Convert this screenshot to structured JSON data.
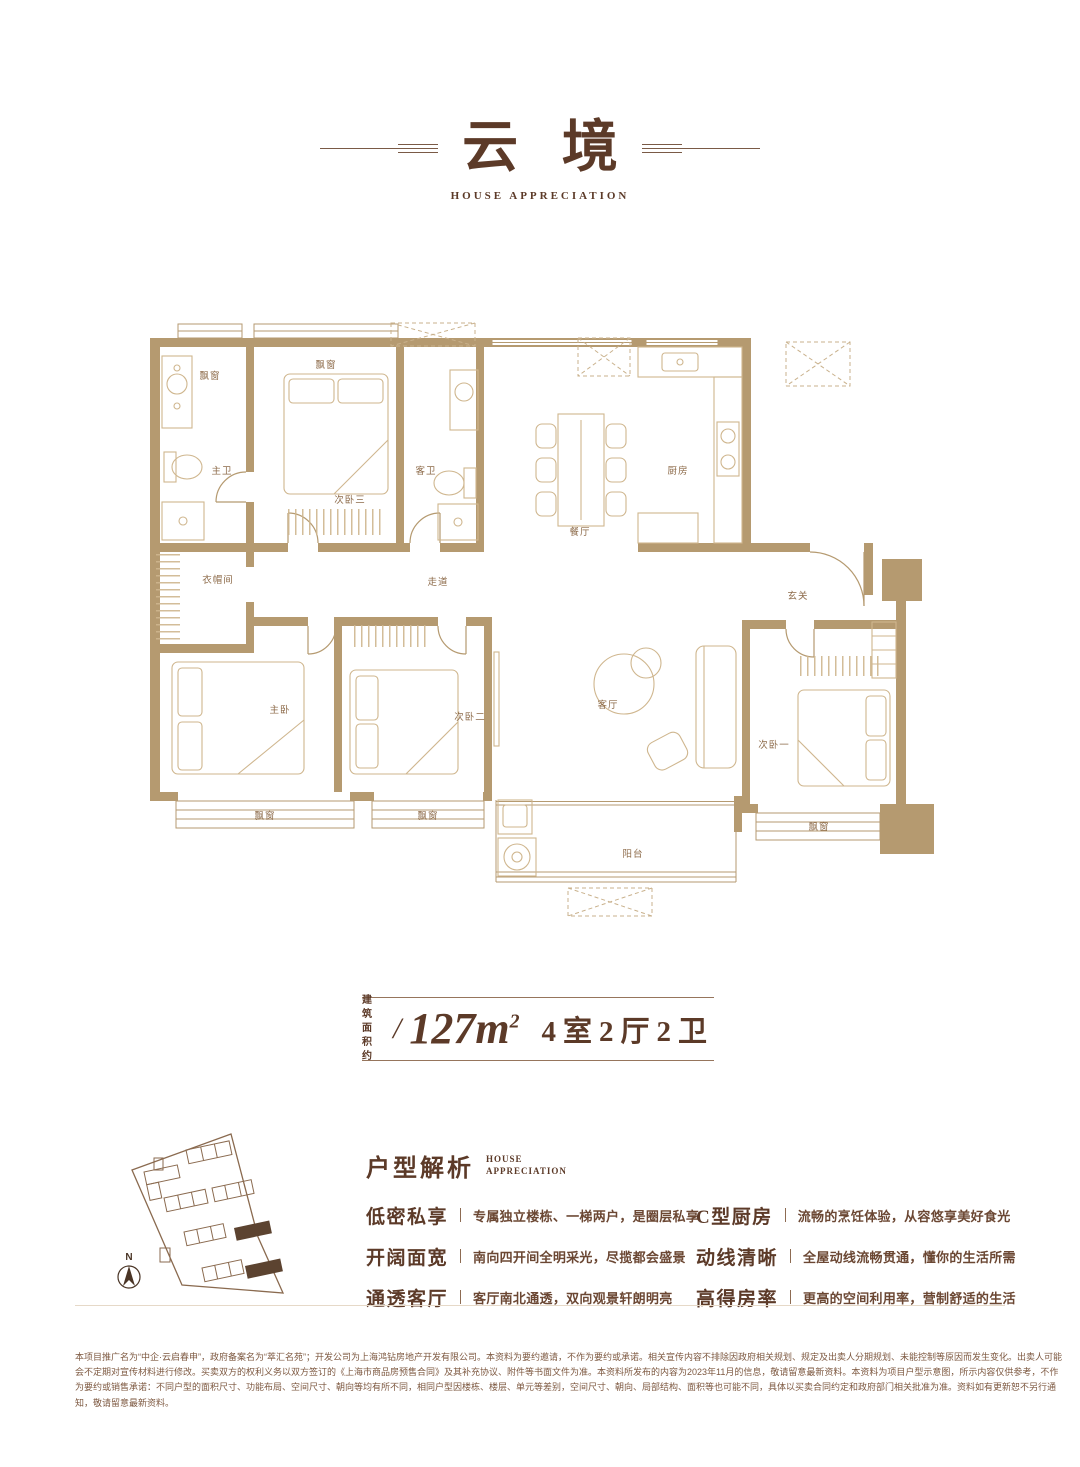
{
  "header": {
    "title": "云境",
    "subtitle": "HOUSE APPRECIATION"
  },
  "floor_plan": {
    "labels": {
      "bay_window": "飘窗",
      "master_bath": "主卫",
      "bedroom3": "次卧三",
      "guest_bath": "客卫",
      "dining": "餐厅",
      "kitchen": "厨房",
      "cloakroom": "衣帽间",
      "corridor": "走道",
      "foyer": "玄关",
      "master_bedroom": "主卧",
      "bedroom2": "次卧二",
      "living": "客厅",
      "bedroom1": "次卧一",
      "balcony": "阳台"
    }
  },
  "area_info": {
    "prefix_top": "建筑",
    "prefix_bottom": "面积约",
    "separator": "/",
    "area": "127m",
    "area_sup": "2",
    "layout": "4室2厅2卫"
  },
  "analysis": {
    "heading": "户型解析",
    "heading_en1": "HOUSE",
    "heading_en2": "APPRECIATION",
    "features_left": [
      {
        "term": "低密私享",
        "desc": "专属独立楼栋、一梯两户，是圈层私享"
      },
      {
        "term": "开阔面宽",
        "desc": "南向四开间全明采光，尽揽都会盛景"
      },
      {
        "term": "通透客厅",
        "desc": "客厅南北通透，双向观景轩朗明亮"
      }
    ],
    "features_right": [
      {
        "term": "C型厨房",
        "desc": "流畅的烹饪体验，从容悠享美好食光"
      },
      {
        "term": "动线清晰",
        "desc": "全屋动线流畅贯通，懂你的生活所需"
      },
      {
        "term": "高得房率",
        "desc": "更高的空间利用率，营制舒适的生活"
      }
    ]
  },
  "site_plan": {
    "compass": "N"
  },
  "disclaimer": {
    "lines": [
      "本项目推广名为“中企·云启春申”，政府备案名为“萃汇名苑”；开发公司为上海鸿钻房地产开发有限公司。本资料为要约邀请，不作为要约或承诺。相关宣传内容不排除因政府相关规划、规定及出卖人分期规划、未能控制等原因而发生变化。出卖人可能",
      "会不定期对宣传材料进行修改。买卖双方的权利义务以双方签订的《上海市商品房预售合同》及其补充协议、附件等书面文件为准。本资料所发布的内容为2023年11月的信息，敬请留意最新资料。本资料为项目户型示意图，所示内容仅供参考，不作",
      "为要约或销售承诺：不同户型的面积尺寸、功能布局、空间尺寸、朝向等均有所不同，相同户型因楼栋、楼层、单元等差别，空间尺寸、朝向、局部结构、面积等也可能不同，具体以买卖合同约定和政府部门相关批准为准。资料如有更新恕不另行通",
      "知，敬请留意最新资料。"
    ]
  },
  "colors": {
    "text_dark": "#5c3a28",
    "wall": "#b59a70",
    "furniture": "#cfb68e",
    "room_label": "#8d6b4a",
    "disclaimer": "#7d5840"
  }
}
